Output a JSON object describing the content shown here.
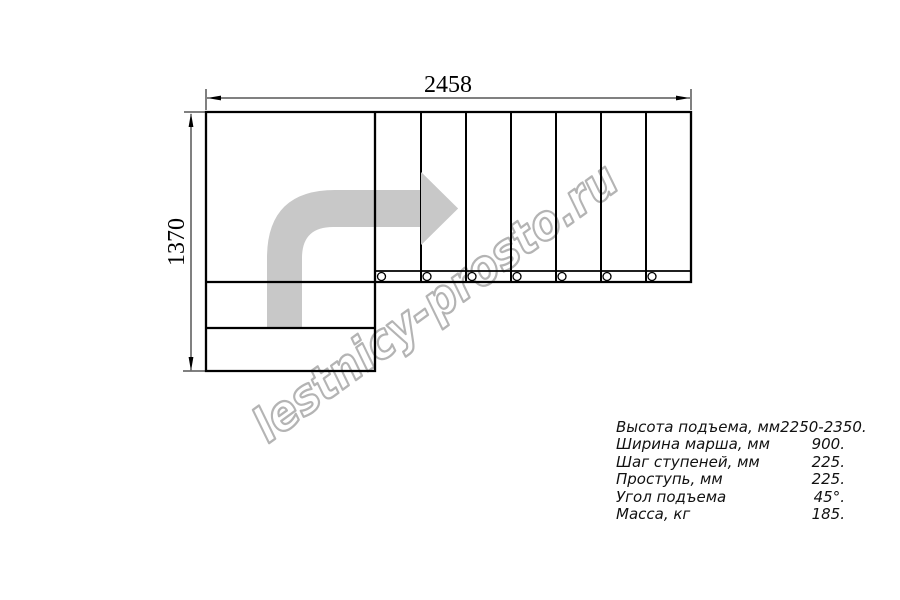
{
  "drawing": {
    "type_note": "L-shaped staircase plan view",
    "dimension_labels": {
      "width": "2458",
      "height": "1370"
    },
    "tread_count": 7,
    "baluster_count": 7
  },
  "watermark": {
    "text": "lestnicy-prosto.ru"
  },
  "specs": {
    "rows": [
      {
        "label": "Высота подъема, мм",
        "value": "2250-2350."
      },
      {
        "label": "Ширина марша, мм",
        "value": "900."
      },
      {
        "label": "Шаг ступеней, мм",
        "value": "225."
      },
      {
        "label": "Проступь, мм",
        "value": "225."
      },
      {
        "label": "Угол подъема",
        "value": "45°."
      },
      {
        "label": "Масса, кг",
        "value": "185."
      }
    ]
  },
  "colors": {
    "line": "#000000",
    "arrow": "#c8c8c8",
    "watermark_outline": "#b4b4b4",
    "background": "#ffffff"
  }
}
